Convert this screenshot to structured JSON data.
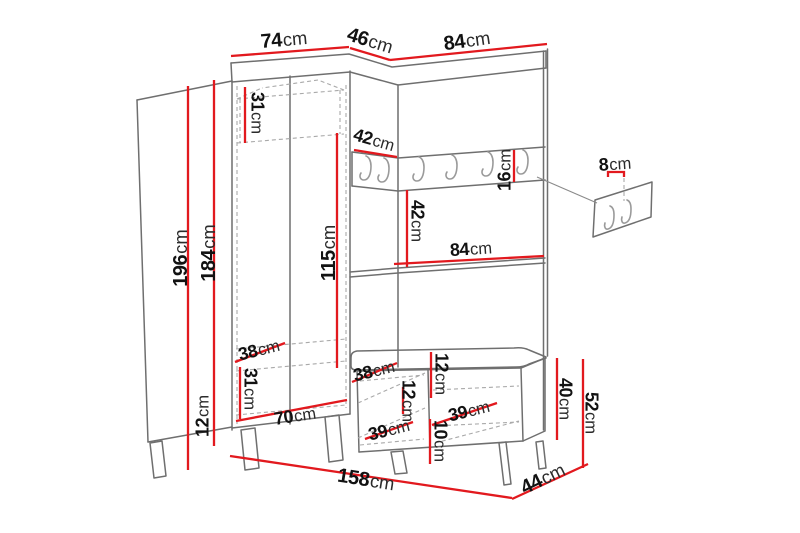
{
  "title": "Hallway furniture set dimension drawing",
  "unit": "cm",
  "colors": {
    "background": "#ffffff",
    "outline": "#6f6f6f",
    "hidden_lines": "#a9a9a9",
    "dimension_line": "#e2191e",
    "text": "#121212"
  },
  "main_unit_hook_count": 6,
  "detail_inset": {
    "hook_count": 2,
    "spacing_label": "8cm"
  },
  "labels": [
    {
      "name": "left-section-top-width",
      "text": "74cm",
      "x": 284,
      "y": 40,
      "rot": -5,
      "fs": 20
    },
    {
      "name": "corner-section-top-width",
      "text": "46cm",
      "x": 370,
      "y": 41,
      "rot": 17,
      "fs": 20
    },
    {
      "name": "right-section-top-width",
      "text": "84cm",
      "x": 467,
      "y": 41,
      "rot": -8,
      "fs": 20
    },
    {
      "name": "top-shelf-height",
      "text": "31cm",
      "x": 257,
      "y": 113,
      "rot": 90,
      "fs": 18
    },
    {
      "name": "total-height",
      "text": "196cm",
      "x": 181,
      "y": 258,
      "rot": -90,
      "fs": 20
    },
    {
      "name": "carcass-height",
      "text": "184cm",
      "x": 209,
      "y": 253,
      "rot": -90,
      "fs": 20
    },
    {
      "name": "hanging-space-height",
      "text": "115cm",
      "x": 329,
      "y": 253,
      "rot": -90,
      "fs": 20
    },
    {
      "name": "hook-rail-corner-width",
      "text": "42cm",
      "x": 374,
      "y": 140,
      "rot": 16,
      "fs": 18
    },
    {
      "name": "hook-rail-height",
      "text": "16cm",
      "x": 505,
      "y": 170,
      "rot": -90,
      "fs": 18
    },
    {
      "name": "hook-spacing",
      "text": "8cm",
      "x": 615,
      "y": 164,
      "rot": -4,
      "fs": 18
    },
    {
      "name": "middle-shelf-opening-height",
      "text": "42cm",
      "x": 417,
      "y": 221,
      "rot": 90,
      "fs": 18
    },
    {
      "name": "shelf-opening-width",
      "text": "84cm",
      "x": 471,
      "y": 249,
      "rot": -4,
      "fs": 18
    },
    {
      "name": "left-section-depth",
      "text": "38cm",
      "x": 259,
      "y": 350,
      "rot": -14,
      "fs": 18
    },
    {
      "name": "left-drawer-height",
      "text": "31cm",
      "x": 250,
      "y": 389,
      "rot": 90,
      "fs": 18
    },
    {
      "name": "left-interior-width",
      "text": "70cm",
      "x": 295,
      "y": 416,
      "rot": -9,
      "fs": 18
    },
    {
      "name": "plinth-height",
      "text": "12cm",
      "x": 203,
      "y": 416,
      "rot": -90,
      "fs": 18
    },
    {
      "name": "middle-drawer-depth",
      "text": "38cm",
      "x": 374,
      "y": 371,
      "rot": -14,
      "fs": 18
    },
    {
      "name": "middle-drawer-height",
      "text": "12cm",
      "x": 408,
      "y": 401,
      "rot": 90,
      "fs": 18
    },
    {
      "name": "middle-interior-width",
      "text": "39cm",
      "x": 389,
      "y": 430,
      "rot": -14,
      "fs": 18
    },
    {
      "name": "seat-cushion-height",
      "text": "12cm",
      "x": 441,
      "y": 374,
      "rot": 90,
      "fs": 18
    },
    {
      "name": "bench-interior-width",
      "text": "39cm",
      "x": 469,
      "y": 411,
      "rot": -14,
      "fs": 18
    },
    {
      "name": "bench-interior-height",
      "text": "10cm",
      "x": 440,
      "y": 441,
      "rot": 90,
      "fs": 18
    },
    {
      "name": "bench-opening-height",
      "text": "40cm",
      "x": 565,
      "y": 399,
      "rot": 90,
      "fs": 18
    },
    {
      "name": "bench-total-height",
      "text": "52cm",
      "x": 591,
      "y": 413,
      "rot": 90,
      "fs": 18
    },
    {
      "name": "total-width",
      "text": "158cm",
      "x": 366,
      "y": 480,
      "rot": 9,
      "fs": 20
    },
    {
      "name": "total-depth",
      "text": "44cm",
      "x": 543,
      "y": 479,
      "rot": -26,
      "fs": 20
    }
  ]
}
